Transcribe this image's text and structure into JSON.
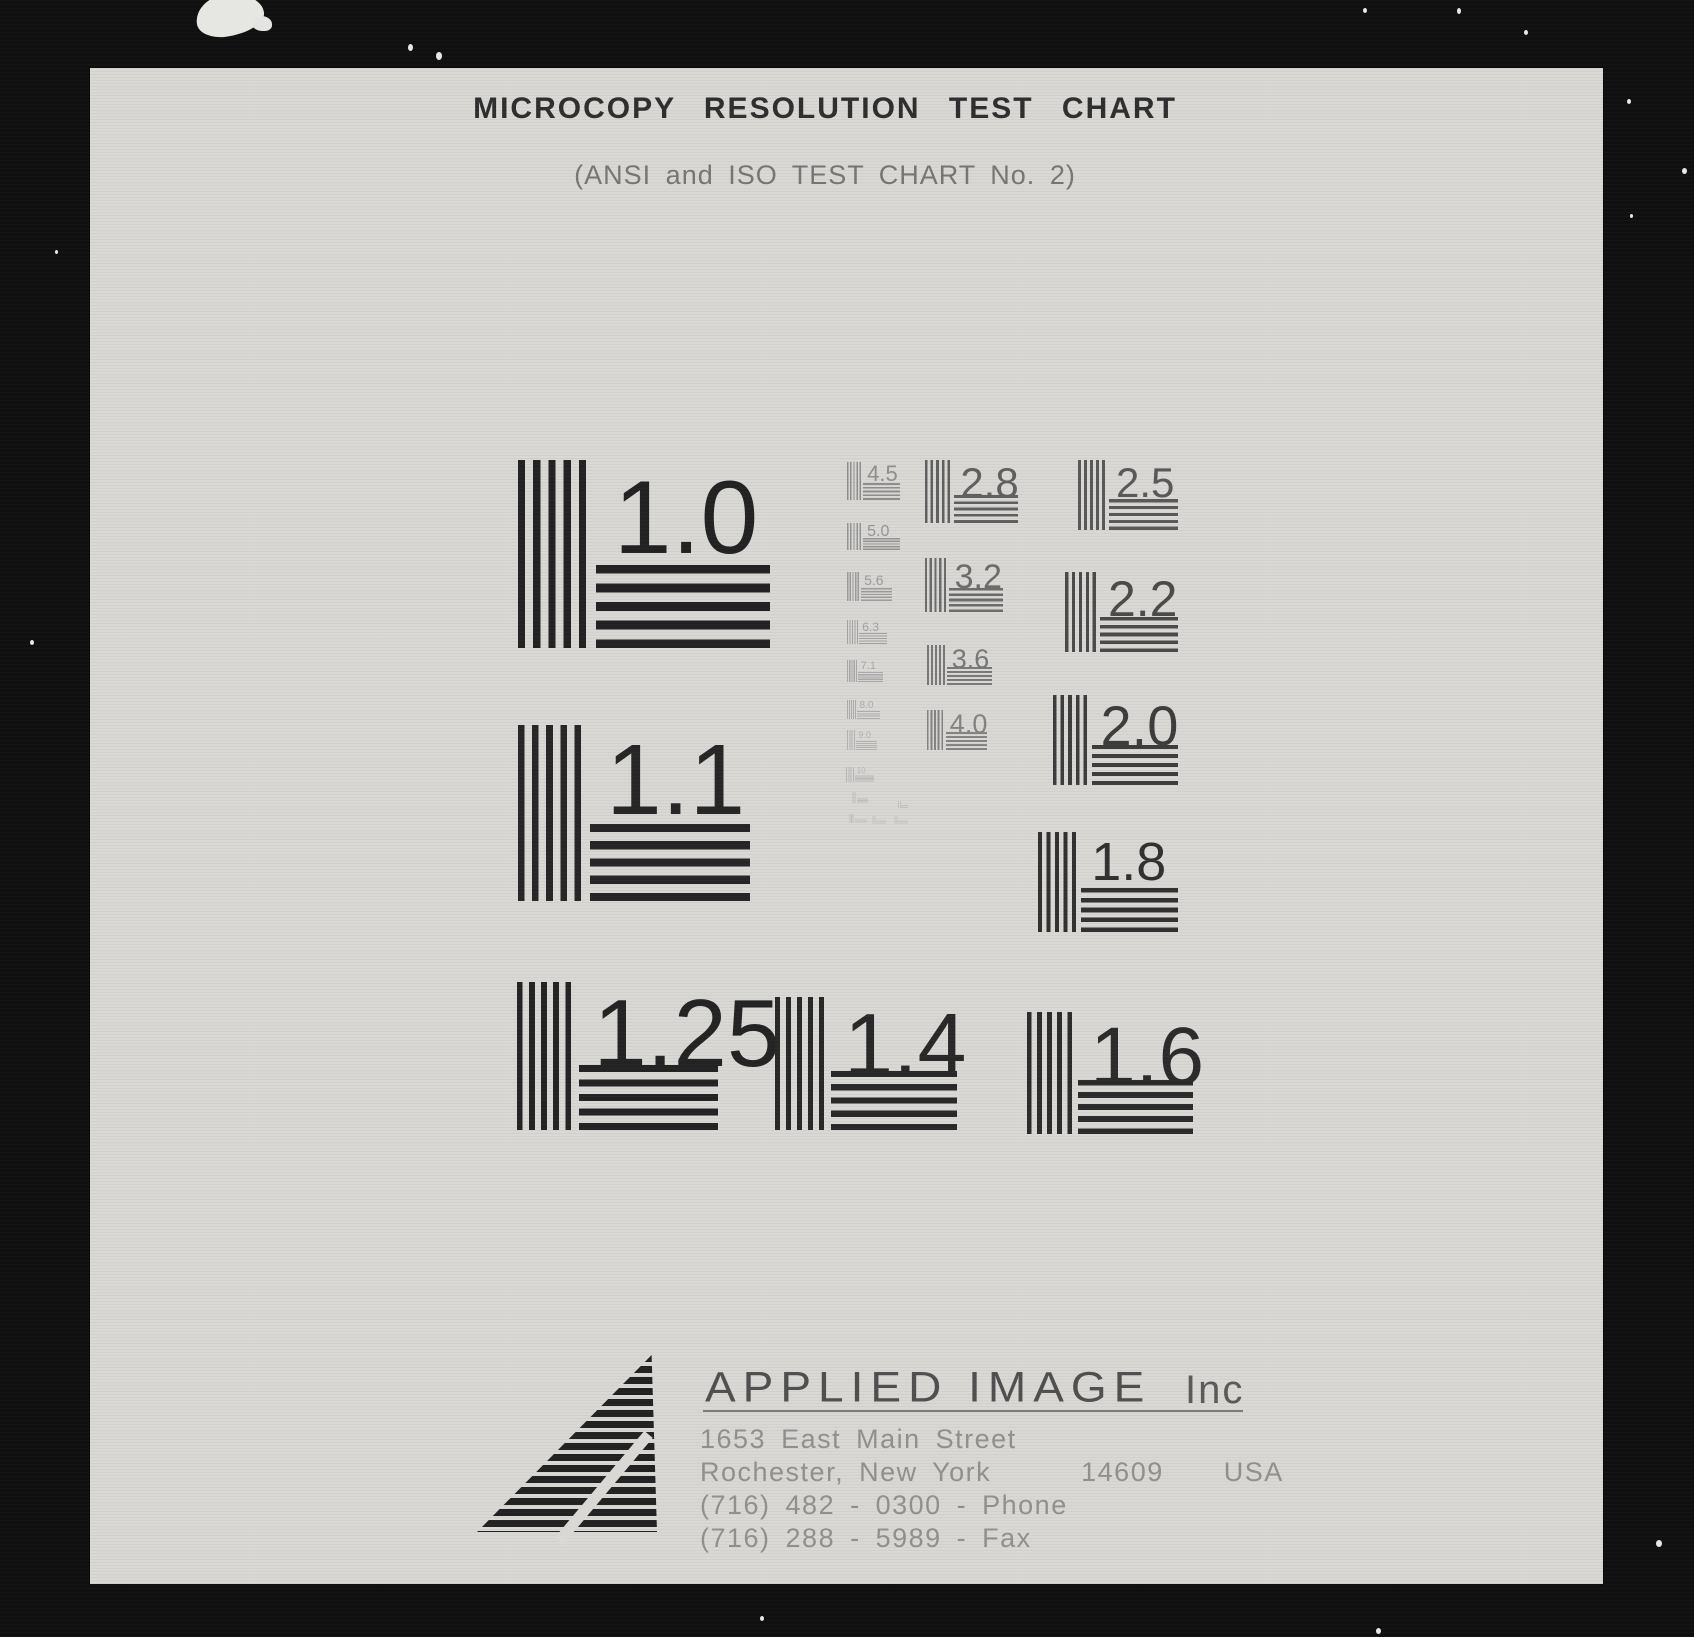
{
  "header": {
    "title": "MICROCOPY RESOLUTION TEST CHART",
    "subtitle": "(ANSI and ISO TEST CHART No. 2)"
  },
  "patterns": [
    {
      "label": "1.0",
      "x": 518,
      "y": 460,
      "w": 252,
      "h": 188,
      "fs": 104,
      "color": "#222222"
    },
    {
      "label": "1.1",
      "x": 518,
      "y": 725,
      "w": 232,
      "h": 176,
      "fs": 100,
      "color": "#262626"
    },
    {
      "label": "1.25",
      "x": 517,
      "y": 982,
      "w": 201,
      "h": 148,
      "fs": 96,
      "color": "#232323"
    },
    {
      "label": "1.4",
      "x": 775,
      "y": 997,
      "w": 182,
      "h": 133,
      "fs": 88,
      "color": "#282828"
    },
    {
      "label": "1.6",
      "x": 1027,
      "y": 1012,
      "w": 166,
      "h": 122,
      "fs": 82,
      "color": "#2b2b2b"
    },
    {
      "label": "1.8",
      "x": 1038,
      "y": 832,
      "w": 140,
      "h": 100,
      "fs": 54,
      "color": "#303030"
    },
    {
      "label": "2.0",
      "x": 1053,
      "y": 695,
      "w": 125,
      "h": 90,
      "fs": 56,
      "color": "#3c3c3c"
    },
    {
      "label": "2.2",
      "x": 1065,
      "y": 572,
      "w": 113,
      "h": 80,
      "fs": 50,
      "color": "#4a4a4a"
    },
    {
      "label": "2.5",
      "x": 1078,
      "y": 460,
      "w": 100,
      "h": 70,
      "fs": 42,
      "color": "#585858"
    },
    {
      "label": "2.8",
      "x": 925,
      "y": 460,
      "w": 93,
      "h": 63,
      "fs": 42,
      "color": "#5f5f5f"
    },
    {
      "label": "3.2",
      "x": 925,
      "y": 558,
      "w": 78,
      "h": 54,
      "fs": 34,
      "color": "#6b6b6b"
    },
    {
      "label": "3.6",
      "x": 927,
      "y": 645,
      "w": 65,
      "h": 40,
      "fs": 27,
      "color": "#777777"
    },
    {
      "label": "4.0",
      "x": 927,
      "y": 710,
      "w": 60,
      "h": 40,
      "fs": 27,
      "color": "#828282"
    },
    {
      "label": "4.5",
      "x": 847,
      "y": 462,
      "w": 53,
      "h": 38,
      "fs": 22,
      "color": "#8d8d8d"
    },
    {
      "label": "5.0",
      "x": 847,
      "y": 523,
      "w": 53,
      "h": 27,
      "fs": 16,
      "color": "#949494"
    },
    {
      "label": "5.6",
      "x": 847,
      "y": 572,
      "w": 45,
      "h": 29,
      "fs": 14,
      "color": "#9a9a9a"
    },
    {
      "label": "6.3",
      "x": 847,
      "y": 620,
      "w": 40,
      "h": 24,
      "fs": 12,
      "color": "#a1a1a1"
    },
    {
      "label": "7.1",
      "x": 847,
      "y": 660,
      "w": 36,
      "h": 22,
      "fs": 11,
      "color": "#a6a6a6"
    },
    {
      "label": "8.0",
      "x": 847,
      "y": 700,
      "w": 33,
      "h": 19,
      "fs": 10,
      "color": "#ababab"
    },
    {
      "label": "9.0",
      "x": 847,
      "y": 730,
      "w": 30,
      "h": 20,
      "fs": 9,
      "color": "#b1b1b1"
    },
    {
      "label": "10",
      "x": 846,
      "y": 767,
      "w": 28,
      "h": 15,
      "fs": 8,
      "color": "#b6b6b6"
    },
    {
      "label": "",
      "x": 852,
      "y": 792,
      "w": 16,
      "h": 11,
      "fs": 0,
      "color": "#bcbcbc"
    },
    {
      "label": "",
      "x": 898,
      "y": 801,
      "w": 10,
      "h": 7,
      "fs": 0,
      "color": "#c0c0c0"
    },
    {
      "label": "",
      "x": 849,
      "y": 814,
      "w": 18,
      "h": 9,
      "fs": 0,
      "color": "#bfbfbf"
    },
    {
      "label": "",
      "x": 872,
      "y": 816,
      "w": 14,
      "h": 8,
      "fs": 0,
      "color": "#c2c2c2"
    },
    {
      "label": "",
      "x": 894,
      "y": 816,
      "w": 14,
      "h": 8,
      "fs": 0,
      "color": "#c2c2c2"
    }
  ],
  "footer": {
    "company": "APPLIED IMAGE",
    "company_suffix": "Inc",
    "address": [
      "1653 East Main Street",
      "Rochester, New York      14609    USA",
      "(716) 482 - 0300 - Phone",
      "(716) 288 - 5989 - Fax"
    ]
  },
  "colors": {
    "backdrop": "#101010",
    "paper": "#d9d8d4",
    "title_ink": "#2e2e2e",
    "subtitle_ink": "#757575",
    "logo_ink": "#4f4f4f",
    "address_ink": "#8f8f8f"
  },
  "artifacts": {
    "blob": {
      "x": 196,
      "y": -6,
      "w": 68,
      "h": 42
    },
    "specks": [
      {
        "x": 408,
        "y": 44,
        "w": 5,
        "h": 7
      },
      {
        "x": 436,
        "y": 52,
        "w": 6,
        "h": 8
      },
      {
        "x": 1363,
        "y": 8,
        "w": 4,
        "h": 5
      },
      {
        "x": 1457,
        "y": 8,
        "w": 4,
        "h": 6
      },
      {
        "x": 1524,
        "y": 30,
        "w": 4,
        "h": 5
      },
      {
        "x": 1627,
        "y": 99,
        "w": 4,
        "h": 5
      },
      {
        "x": 1682,
        "y": 168,
        "w": 5,
        "h": 6
      },
      {
        "x": 1630,
        "y": 214,
        "w": 3,
        "h": 4
      },
      {
        "x": 55,
        "y": 250,
        "w": 3,
        "h": 4
      },
      {
        "x": 30,
        "y": 640,
        "w": 4,
        "h": 5
      },
      {
        "x": 1656,
        "y": 1540,
        "w": 6,
        "h": 7
      },
      {
        "x": 1376,
        "y": 1628,
        "w": 5,
        "h": 6
      },
      {
        "x": 760,
        "y": 1616,
        "w": 4,
        "h": 5
      }
    ]
  }
}
